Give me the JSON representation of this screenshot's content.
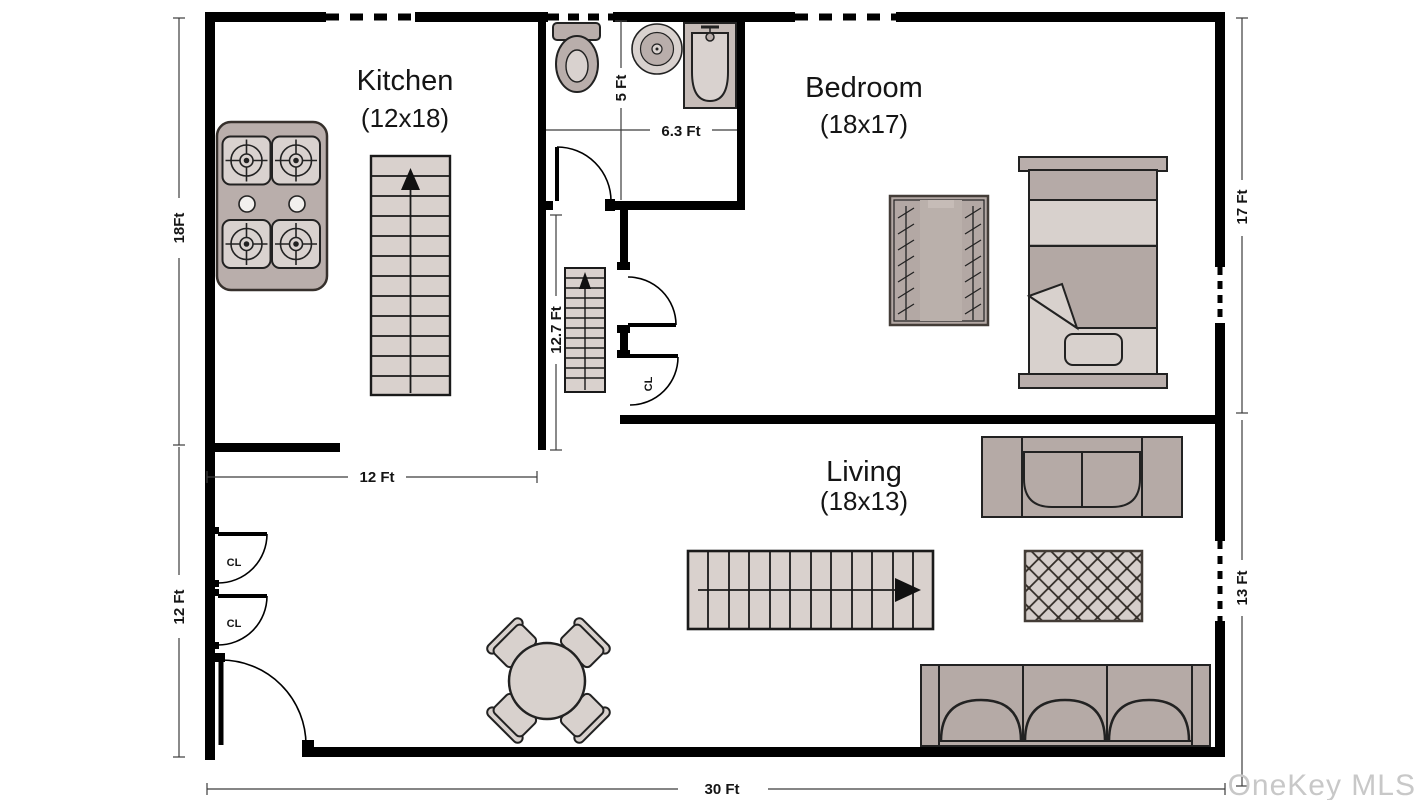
{
  "rooms": {
    "kitchen": {
      "name": "Kitchen",
      "size": "(12x18)"
    },
    "bedroom": {
      "name": "Bedroom",
      "size": "(18x17)"
    },
    "living": {
      "name": "Living",
      "size": "(18x13)"
    }
  },
  "dimensions": {
    "left_top": "18Ft",
    "left_bottom": "12 Ft",
    "kitchen_width": "12 Ft",
    "hall_stairs": "12.7 Ft",
    "bath_height": "5 Ft",
    "bath_width": "6.3 Ft",
    "right_top": "17 Ft",
    "right_bottom": "13 Ft",
    "bottom": "30 Ft"
  },
  "labels": {
    "closet": "CL"
  },
  "watermark": {
    "text": "OneKey MLS",
    "color": "#c8c8c8"
  },
  "colors": {
    "wall": "#000000",
    "furniture": "#b5aaa6",
    "furniture_light": "#d8d1cd",
    "outline": "#222222",
    "rug_dark": "#b3a8a4",
    "watermark": "#c8c8c8"
  }
}
